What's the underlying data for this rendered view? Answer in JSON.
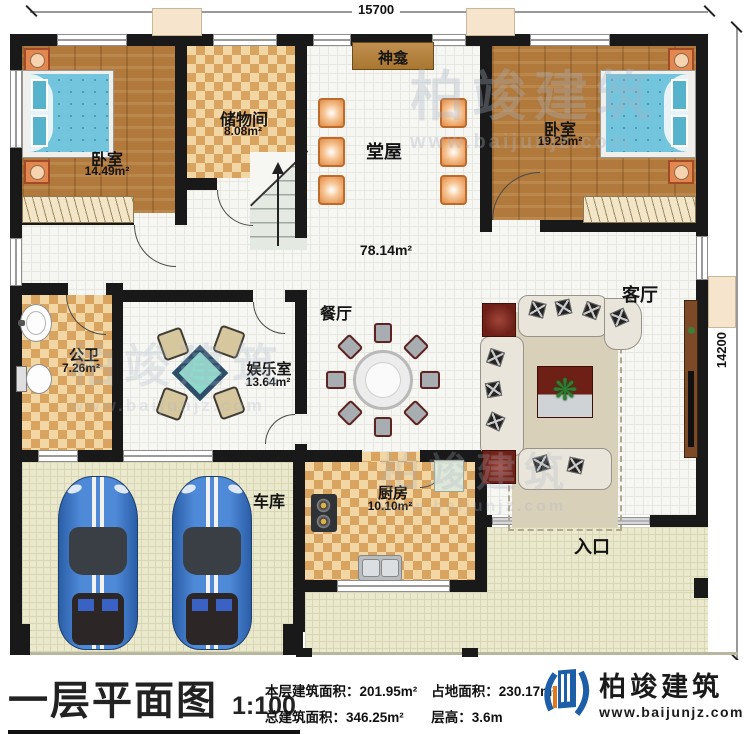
{
  "plan": {
    "dim_top": "15700",
    "dim_right": "14200",
    "rooms": {
      "bedroom1": {
        "label": "卧室",
        "area": "14.49m²"
      },
      "storage": {
        "label": "储物间",
        "area": "8.08m²"
      },
      "shrine": {
        "label": "神龛"
      },
      "hall": {
        "label": "堂屋",
        "area": "78.14m²"
      },
      "bedroom2": {
        "label": "卧室",
        "area": "19.25m²"
      },
      "bathroom": {
        "label": "公卫",
        "area": "7.26m²"
      },
      "game_room": {
        "label": "娱乐室",
        "area": "13.64m²"
      },
      "dining": {
        "label": "餐厅"
      },
      "living": {
        "label": "客厅"
      },
      "kitchen": {
        "label": "厨房",
        "area": "10.10m²"
      },
      "garage": {
        "label": "车库"
      },
      "entrance": {
        "label": "入口"
      }
    }
  },
  "title_block": {
    "title": "一层平面图",
    "scale": "1:100",
    "stats": {
      "floor_area_label": "本层建筑面积：",
      "floor_area_value": "201.95m²",
      "land_area_label": "占地面积：",
      "land_area_value": "230.17m²",
      "total_area_label": "总建筑面积：",
      "total_area_value": "346.25m²",
      "height_label": "层高：",
      "height_value": "3.6m"
    }
  },
  "brand": {
    "name": "柏竣建筑",
    "url": "www.baijunjz.com",
    "accent": "#1c5fa8"
  },
  "watermark": {
    "name": "柏竣建筑",
    "url": "www.baijunjz.com"
  }
}
